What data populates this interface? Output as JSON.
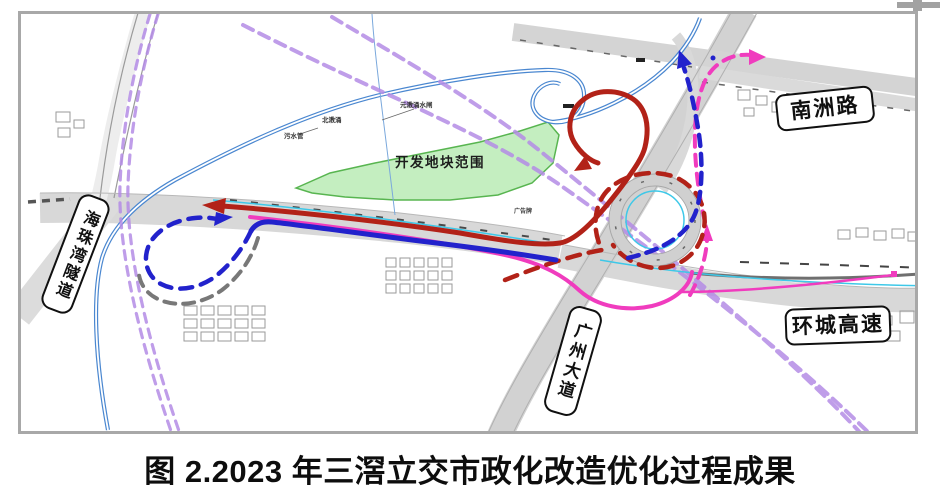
{
  "figure_caption": "图 2.2023 年三滘立交市政化改造优化过程成果",
  "map": {
    "labels": {
      "nanzhou_road": "南洲路",
      "haizhuwan_tunnel": "海珠湾隧道",
      "guangzhou_avenue": "广州大道",
      "huancheng_expressway": "环城高速",
      "development_area": "开发地块范围"
    },
    "tiny_labels": {
      "creek": "北漖涌",
      "sewer_pipe": "污水管",
      "sluice": "元漖涌水闸",
      "billboard": "广告牌"
    },
    "colors": {
      "route_red": "#B22218",
      "route_blue": "#2222CC",
      "route_magenta": "#F03CBE",
      "planned_purple": "#B48CE6",
      "river_blue": "#4A87D0",
      "cyan_line": "#3EC8E8",
      "development_green": "#9FE39A",
      "development_green_edge": "#58B550",
      "road_grey": "#D6D6D6",
      "frame_grey": "#A8A8A8"
    }
  }
}
